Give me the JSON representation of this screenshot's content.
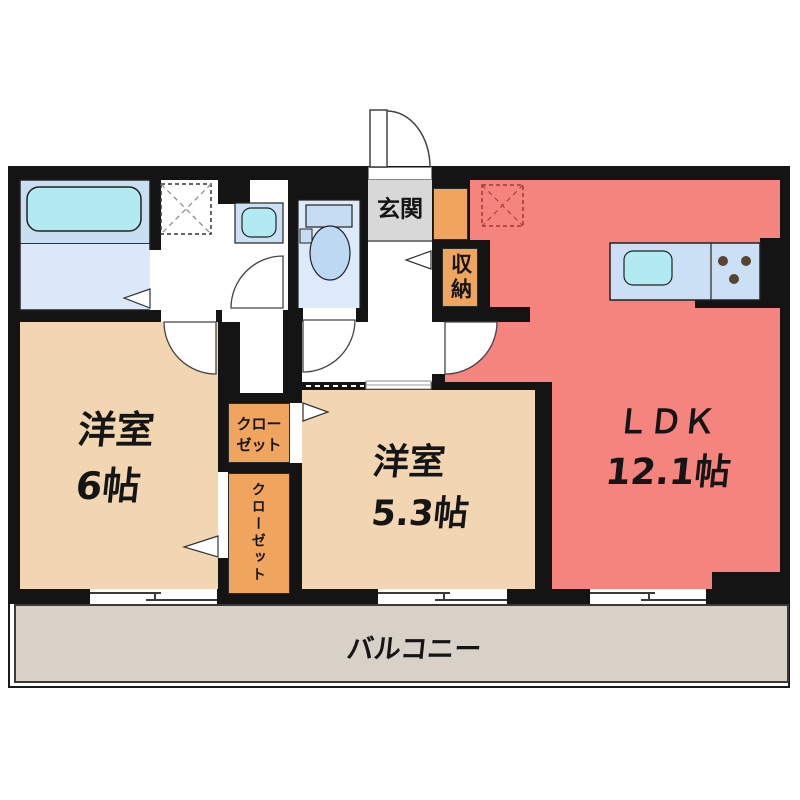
{
  "labels": {
    "bedroom1_name": "洋室",
    "bedroom1_size": "6帖",
    "bedroom2_name": "洋室",
    "bedroom2_size": "5.3帖",
    "ldk_name": "ＬＤＫ",
    "ldk_size": "12.1帖",
    "entrance": "玄関",
    "storage": "収納",
    "closet_upper_line1": "クロー",
    "closet_upper_line2": "ゼット",
    "closet_lower": "クローゼット",
    "balcony": "バルコニー"
  },
  "colors": {
    "wall": "#141414",
    "bedroom_floor": "#f2d6b2",
    "ldk_floor": "#f5837e",
    "closet_fill": "#f0a55f",
    "entrance_floor": "#d8d8d8",
    "balcony_floor": "#d8d1c8",
    "bath_floor": "#c8def1",
    "washlet_floor": "#dceafa",
    "fixture_blue": "#b2eaf2",
    "counter_blue": "#cbe0f5",
    "burner_brown": "#5a4330"
  }
}
